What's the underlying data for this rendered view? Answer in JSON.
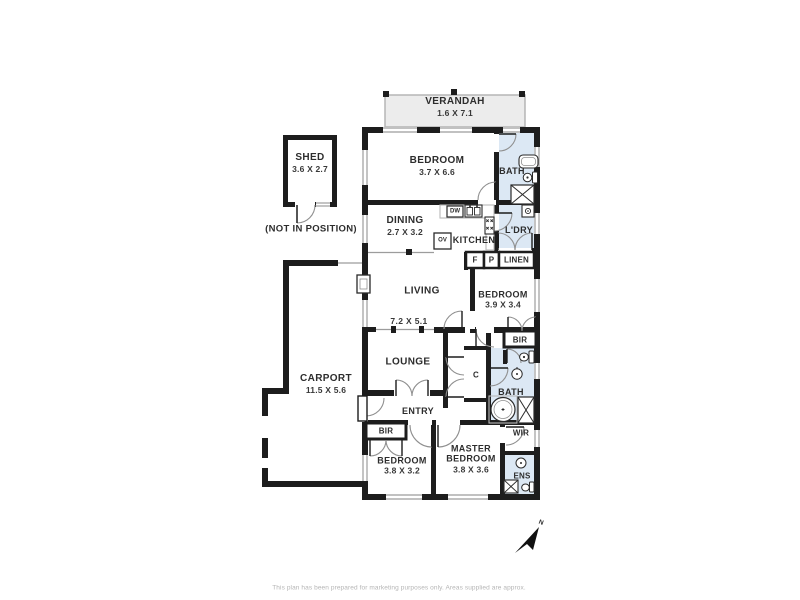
{
  "plan": {
    "footer": {
      "disclaimer": "This plan has been prepared for marketing purposes only. Areas supplied are approx."
    },
    "compass": {
      "label": "N"
    },
    "rooms": {
      "verandah": {
        "name": "VERANDAH",
        "dim": "1.6 X 7.1"
      },
      "shed": {
        "name": "SHED",
        "dim": "3.6 X 2.7",
        "note": "(NOT IN POSITION)"
      },
      "bedroom_top": {
        "name": "BEDROOM",
        "dim": "3.7 X 6.6"
      },
      "bath_top": {
        "name": "BATH"
      },
      "dining": {
        "name": "DINING",
        "dim": "2.7 X 3.2"
      },
      "kitchen": {
        "name": "KITCHEN"
      },
      "laundry": {
        "name": "L'DRY"
      },
      "living": {
        "name": "LIVING",
        "dim": "7.2 X 5.1"
      },
      "bedroom_mid": {
        "name": "BEDROOM",
        "dim": "3.9 X 3.4"
      },
      "lounge": {
        "name": "LOUNGE"
      },
      "carport": {
        "name": "CARPORT",
        "dim": "11.5 X 5.6"
      },
      "entry": {
        "name": "ENTRY"
      },
      "bath_mid": {
        "name": "BATH"
      },
      "bedroom_bottom": {
        "name": "BEDROOM",
        "dim": "3.8 X 3.2"
      },
      "master_bedroom": {
        "name": "MASTER BEDROOM",
        "dim": "3.8 X 3.6"
      },
      "wir": {
        "name": "WIR"
      },
      "ens": {
        "name": "ENS"
      }
    },
    "storage": {
      "linen": "LINEN",
      "fridge": "F",
      "pantry": "P",
      "bir_mid": "BIR",
      "bir_bottom": "BIR",
      "cupboard": "C"
    },
    "appliances": {
      "dishwasher": "DW",
      "oven": "OV"
    },
    "colors": {
      "wall": "#1d1d1d",
      "wet_area": "#dce8f4",
      "verandah_fill": "#ececec",
      "outline_gray": "#9c9c9c"
    }
  }
}
